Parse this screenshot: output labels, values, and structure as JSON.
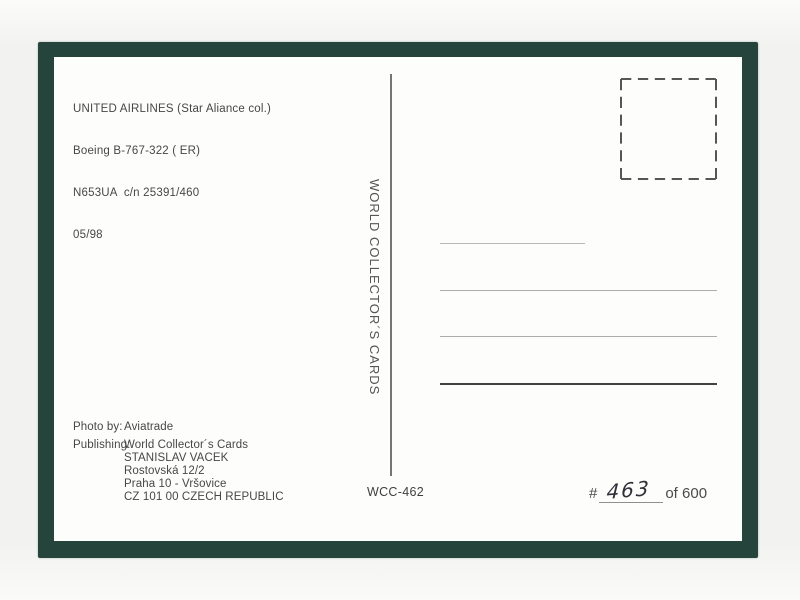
{
  "colors": {
    "page_bg": "#f4f4f2",
    "frame": "#24443c",
    "card_bg": "#fdfdfb",
    "ink": "#474747",
    "rule_light": "#b8b8b8",
    "rule_strong": "#424242",
    "handwriting_ink": "#30303a"
  },
  "card": {
    "caption_lines": [
      "UNITED AIRLINES (Star Aliance col.)",
      "Boeing B-767-322 ( ER)",
      "N653UA  c/n 25391/460",
      "05/98"
    ],
    "brand_vertical": "WORLD COLLECTOR´S CARDS",
    "catalog_number": "WCC-462",
    "credits": {
      "photo_label": "Photo by:",
      "photo_value": "Aviatrade",
      "publishing_label": "Publishing:",
      "publishing_lines": [
        "World Collector´s Cards",
        "STANISLAV VACEK",
        "Rostovská 12/2",
        "Praha 10 - Vršovice",
        "CZ 101 00 CZECH REPUBLIC"
      ]
    },
    "numbering": {
      "hash": "#",
      "handwritten_number": "463",
      "total_label": "of 600"
    }
  }
}
